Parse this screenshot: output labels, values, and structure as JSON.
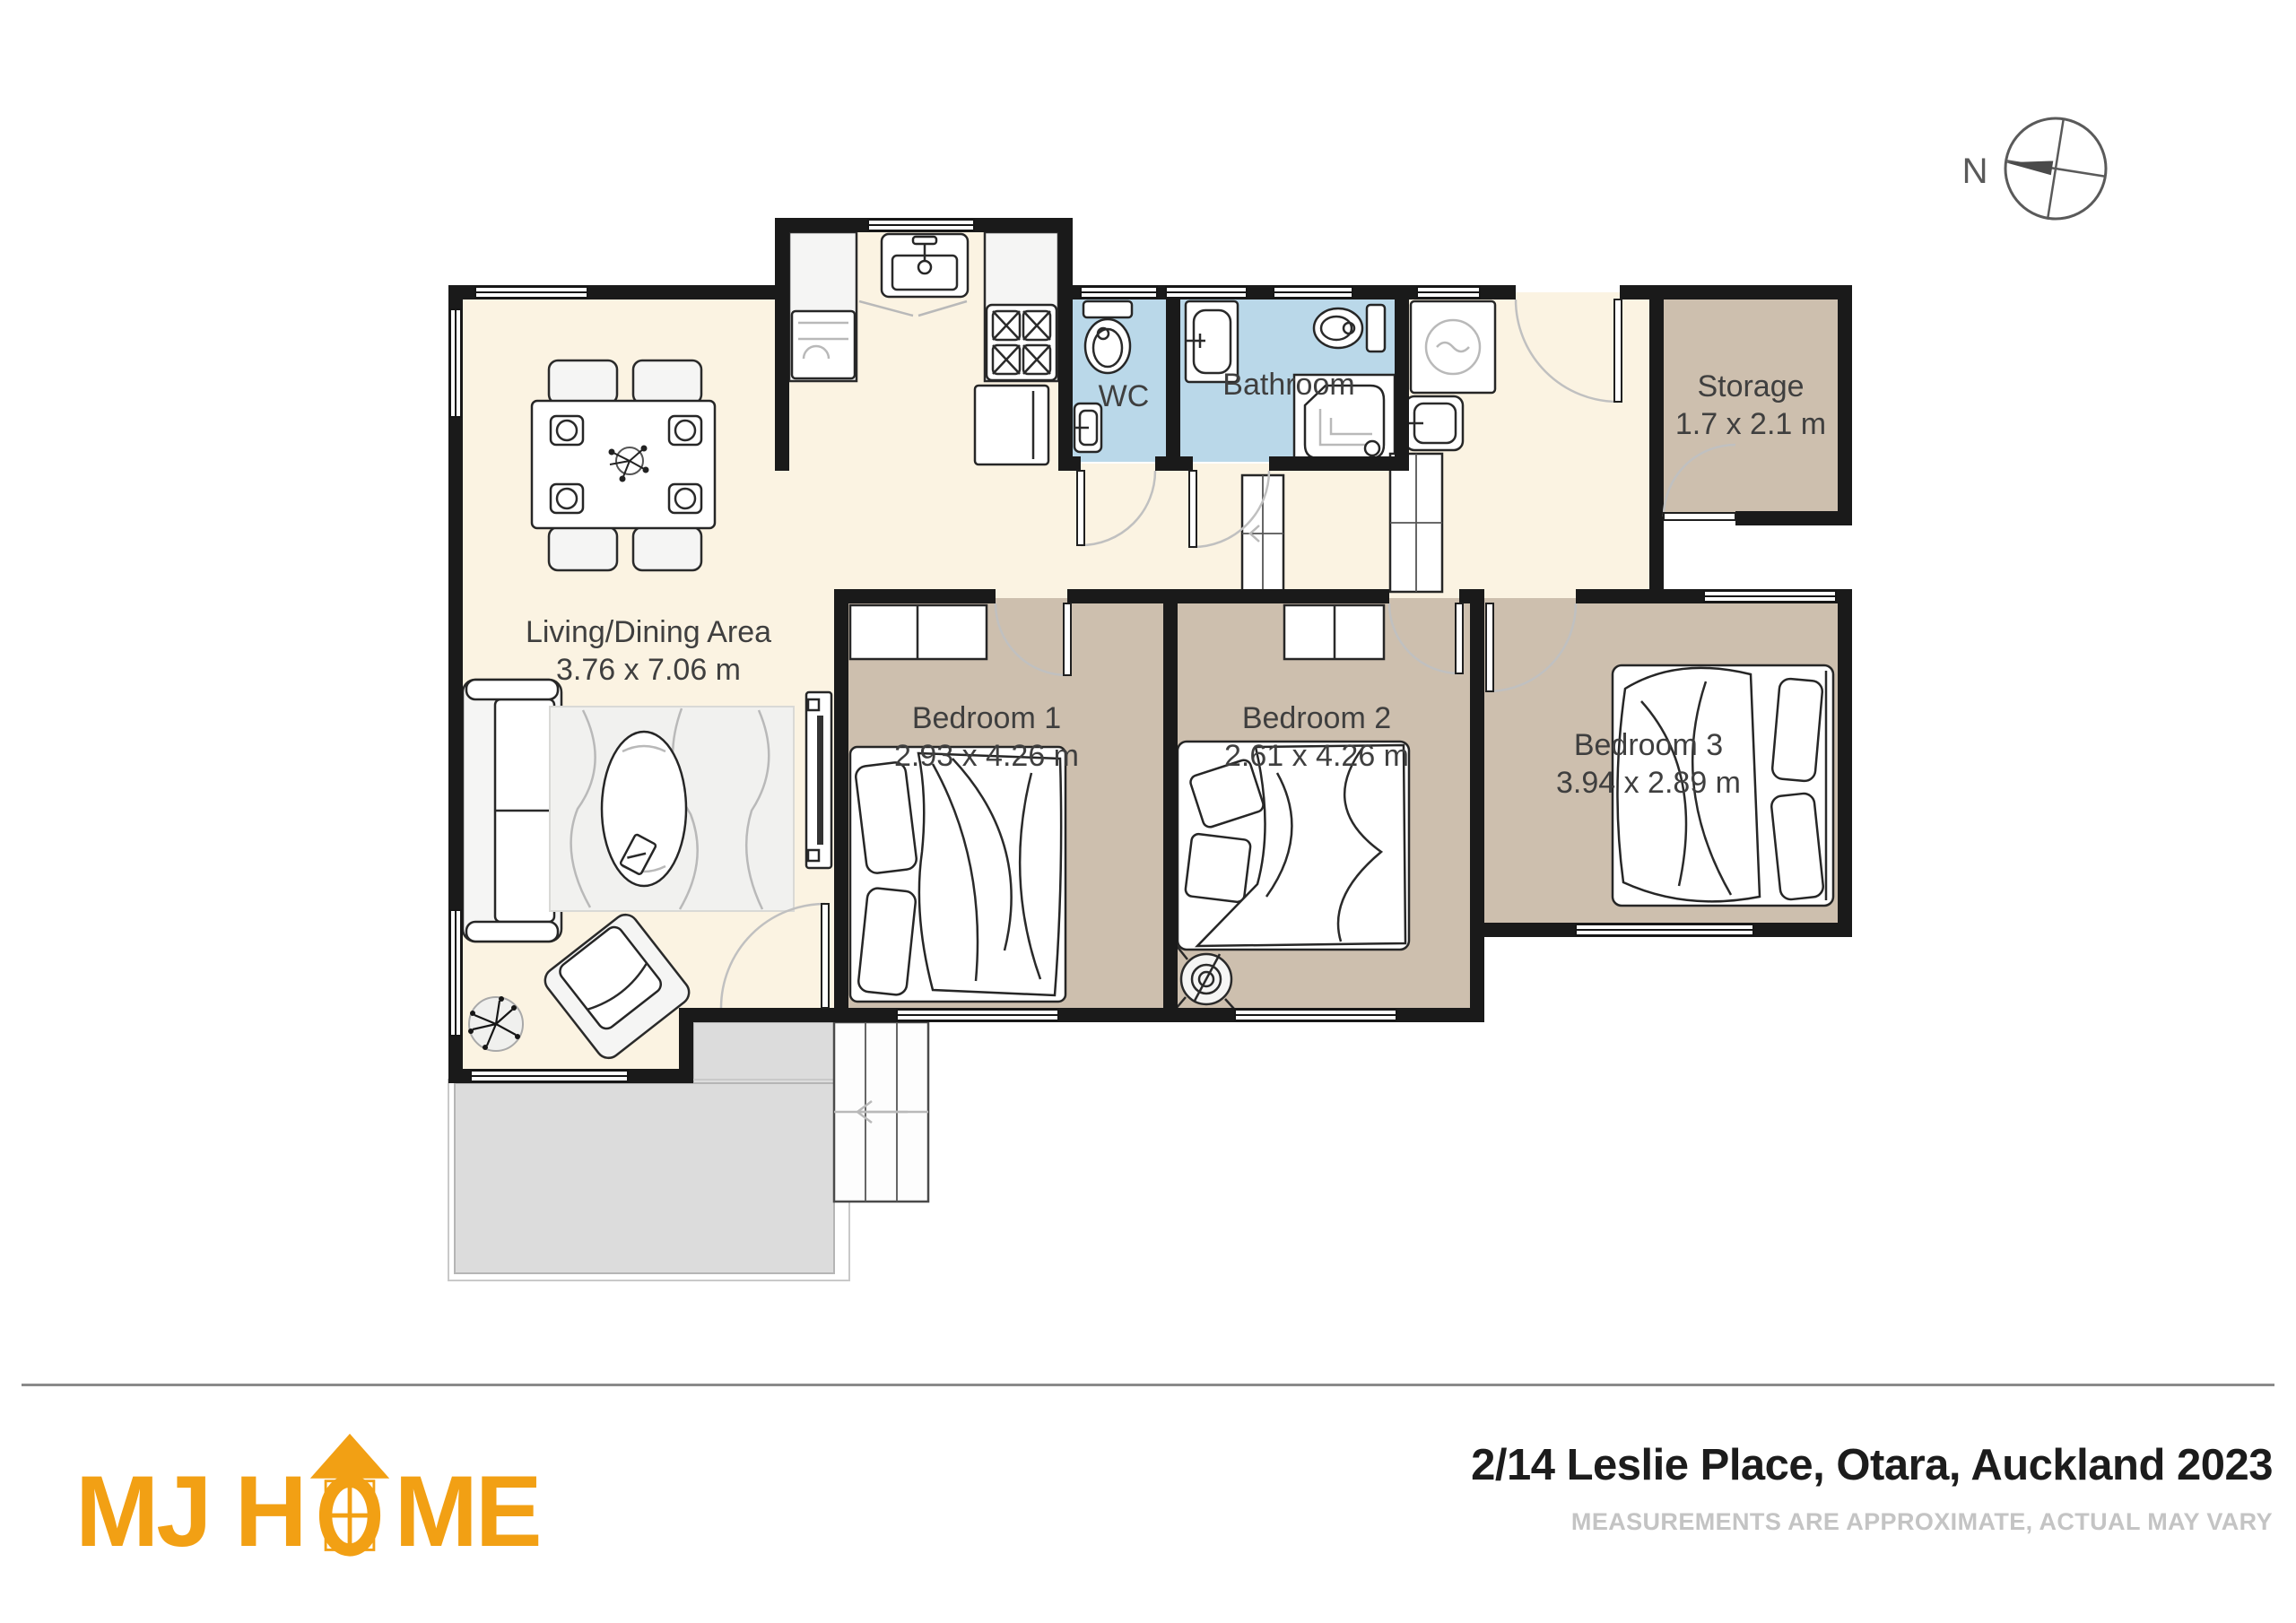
{
  "plan": {
    "compass": {
      "label": "N"
    },
    "rooms": [
      {
        "id": "living-dining",
        "label": "Living/Dining Area",
        "dims": "3.76 x 7.06 m"
      },
      {
        "id": "wc",
        "label": "WC",
        "dims": ""
      },
      {
        "id": "bathroom",
        "label": "Bathroom",
        "dims": ""
      },
      {
        "id": "storage",
        "label": "Storage",
        "dims": "1.7 x 2.1 m"
      },
      {
        "id": "bedroom-1",
        "label": "Bedroom 1",
        "dims": "2.93 x 4.26 m"
      },
      {
        "id": "bedroom-2",
        "label": "Bedroom 2",
        "dims": "2.61 x 4.26 m"
      },
      {
        "id": "bedroom-3",
        "label": "Bedroom 3",
        "dims": "3.94 x 2.89 m"
      }
    ]
  },
  "footer": {
    "brand_part1": "MJ H",
    "brand_part2": "ME",
    "address": "2/14 Leslie Place, Otara, Auckland 2023",
    "disclaimer": "MEASUREMENTS ARE APPROXIMATE, ACTUAL MAY VARY"
  },
  "colors": {
    "accent": "#F2A014",
    "wall": "#1A1A1A",
    "floor_cream": "#FBF3E2",
    "floor_room": "#CDBFAE",
    "floor_wet": "#BAD8E9",
    "deck": "#DCDCDC",
    "label": "#3F3F3F",
    "divider": "#8A8A8A",
    "address_text": "#1C1C1C",
    "disclaimer_text": "#C4C4C4",
    "compass": "#5A5A5A"
  }
}
